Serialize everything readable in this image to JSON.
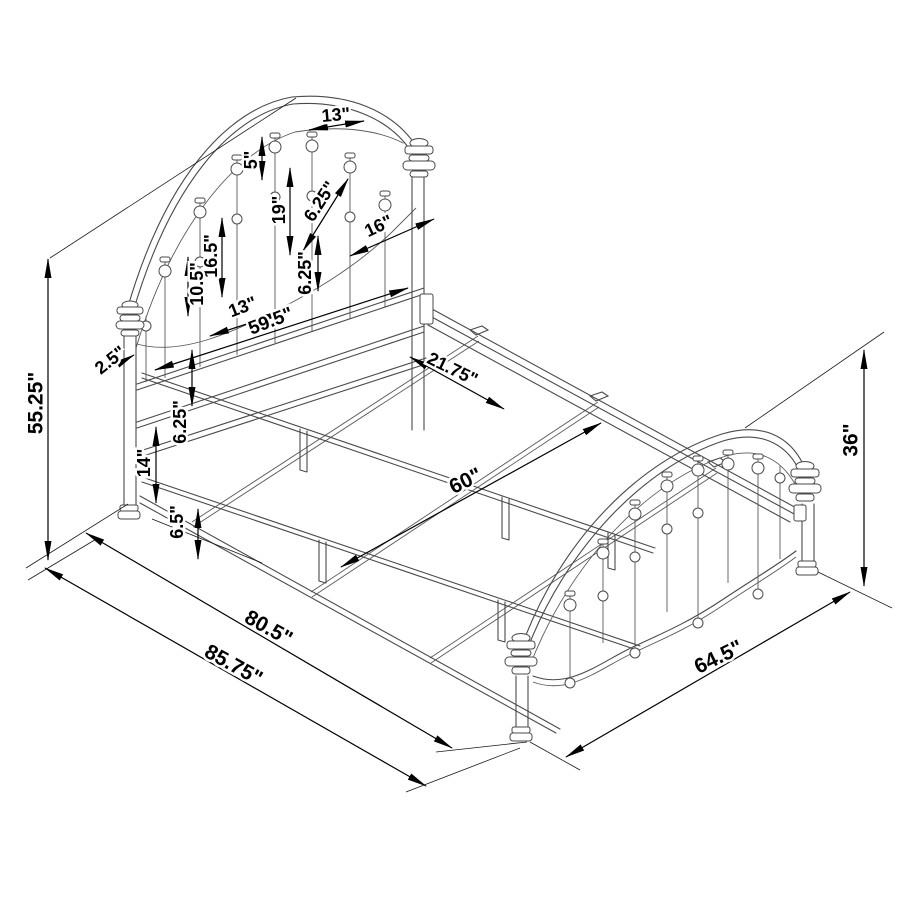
{
  "diagram": {
    "type": "isometric-product-dimension-drawing",
    "subject": "metal bed frame with arched spindle headboard and footboard",
    "units": "inches",
    "background_color": "#ffffff",
    "line_color": "#4a4a4a",
    "dimension_color": "#000000"
  },
  "dimensions": [
    {
      "name": "headboard-arch-spindle-spacing",
      "text": "13\"",
      "x": 336,
      "y": 116,
      "rot": -5,
      "size": 18
    },
    {
      "name": "arch-tube-gap",
      "text": "5\"",
      "x": 252,
      "y": 160,
      "rot": -90,
      "size": 18
    },
    {
      "name": "upper-spindle-spacing",
      "text": "6.25\"",
      "x": 321,
      "y": 202,
      "rot": -57,
      "size": 18
    },
    {
      "name": "spindle-length-right",
      "text": "19\"",
      "x": 280,
      "y": 210,
      "rot": -90,
      "size": 18
    },
    {
      "name": "rail-to-post-gap",
      "text": "16\"",
      "x": 379,
      "y": 227,
      "rot": -25,
      "size": 18
    },
    {
      "name": "spindle-length-mid",
      "text": "16.5\"",
      "x": 212,
      "y": 256,
      "rot": -90,
      "size": 18
    },
    {
      "name": "spindle-length-left",
      "text": "10.5\"",
      "x": 198,
      "y": 284,
      "rot": -90,
      "size": 18
    },
    {
      "name": "center-rail-gap",
      "text": "6.25\"",
      "x": 306,
      "y": 273,
      "rot": -90,
      "size": 18
    },
    {
      "name": "lower-spindle-spacing",
      "text": "13\"",
      "x": 243,
      "y": 308,
      "rot": -21,
      "size": 18
    },
    {
      "name": "headboard-width",
      "text": "59.5\"",
      "x": 271,
      "y": 322,
      "rot": -21,
      "size": 19
    },
    {
      "name": "post-diameter",
      "text": "2.5\"",
      "x": 111,
      "y": 361,
      "rot": -38,
      "size": 18
    },
    {
      "name": "headboard-height",
      "text": "55.25\"",
      "x": 37,
      "y": 403,
      "rot": -90,
      "size": 21
    },
    {
      "name": "rail-band-gap",
      "text": "6.25\"",
      "x": 181,
      "y": 422,
      "rot": -90,
      "size": 18
    },
    {
      "name": "side-rail-height",
      "text": "14\"",
      "x": 145,
      "y": 463,
      "rot": -90,
      "size": 18
    },
    {
      "name": "slat-spacing",
      "text": "21.75\"",
      "x": 452,
      "y": 370,
      "rot": 26,
      "size": 18
    },
    {
      "name": "bed-width",
      "text": "60\"",
      "x": 466,
      "y": 482,
      "rot": -26,
      "size": 21
    },
    {
      "name": "rail-ground-clearance",
      "text": "6.5\"",
      "x": 178,
      "y": 522,
      "rot": -90,
      "size": 18
    },
    {
      "name": "bed-length-inner",
      "text": "80.5\"",
      "x": 268,
      "y": 629,
      "rot": 29,
      "size": 21
    },
    {
      "name": "overall-length",
      "text": "85.75\"",
      "x": 233,
      "y": 666,
      "rot": 29,
      "size": 21
    },
    {
      "name": "footboard-height",
      "text": "36\"",
      "x": 852,
      "y": 440,
      "rot": -90,
      "size": 21
    },
    {
      "name": "footboard-width",
      "text": "64.5\"",
      "x": 719,
      "y": 658,
      "rot": -26,
      "size": 21
    }
  ]
}
